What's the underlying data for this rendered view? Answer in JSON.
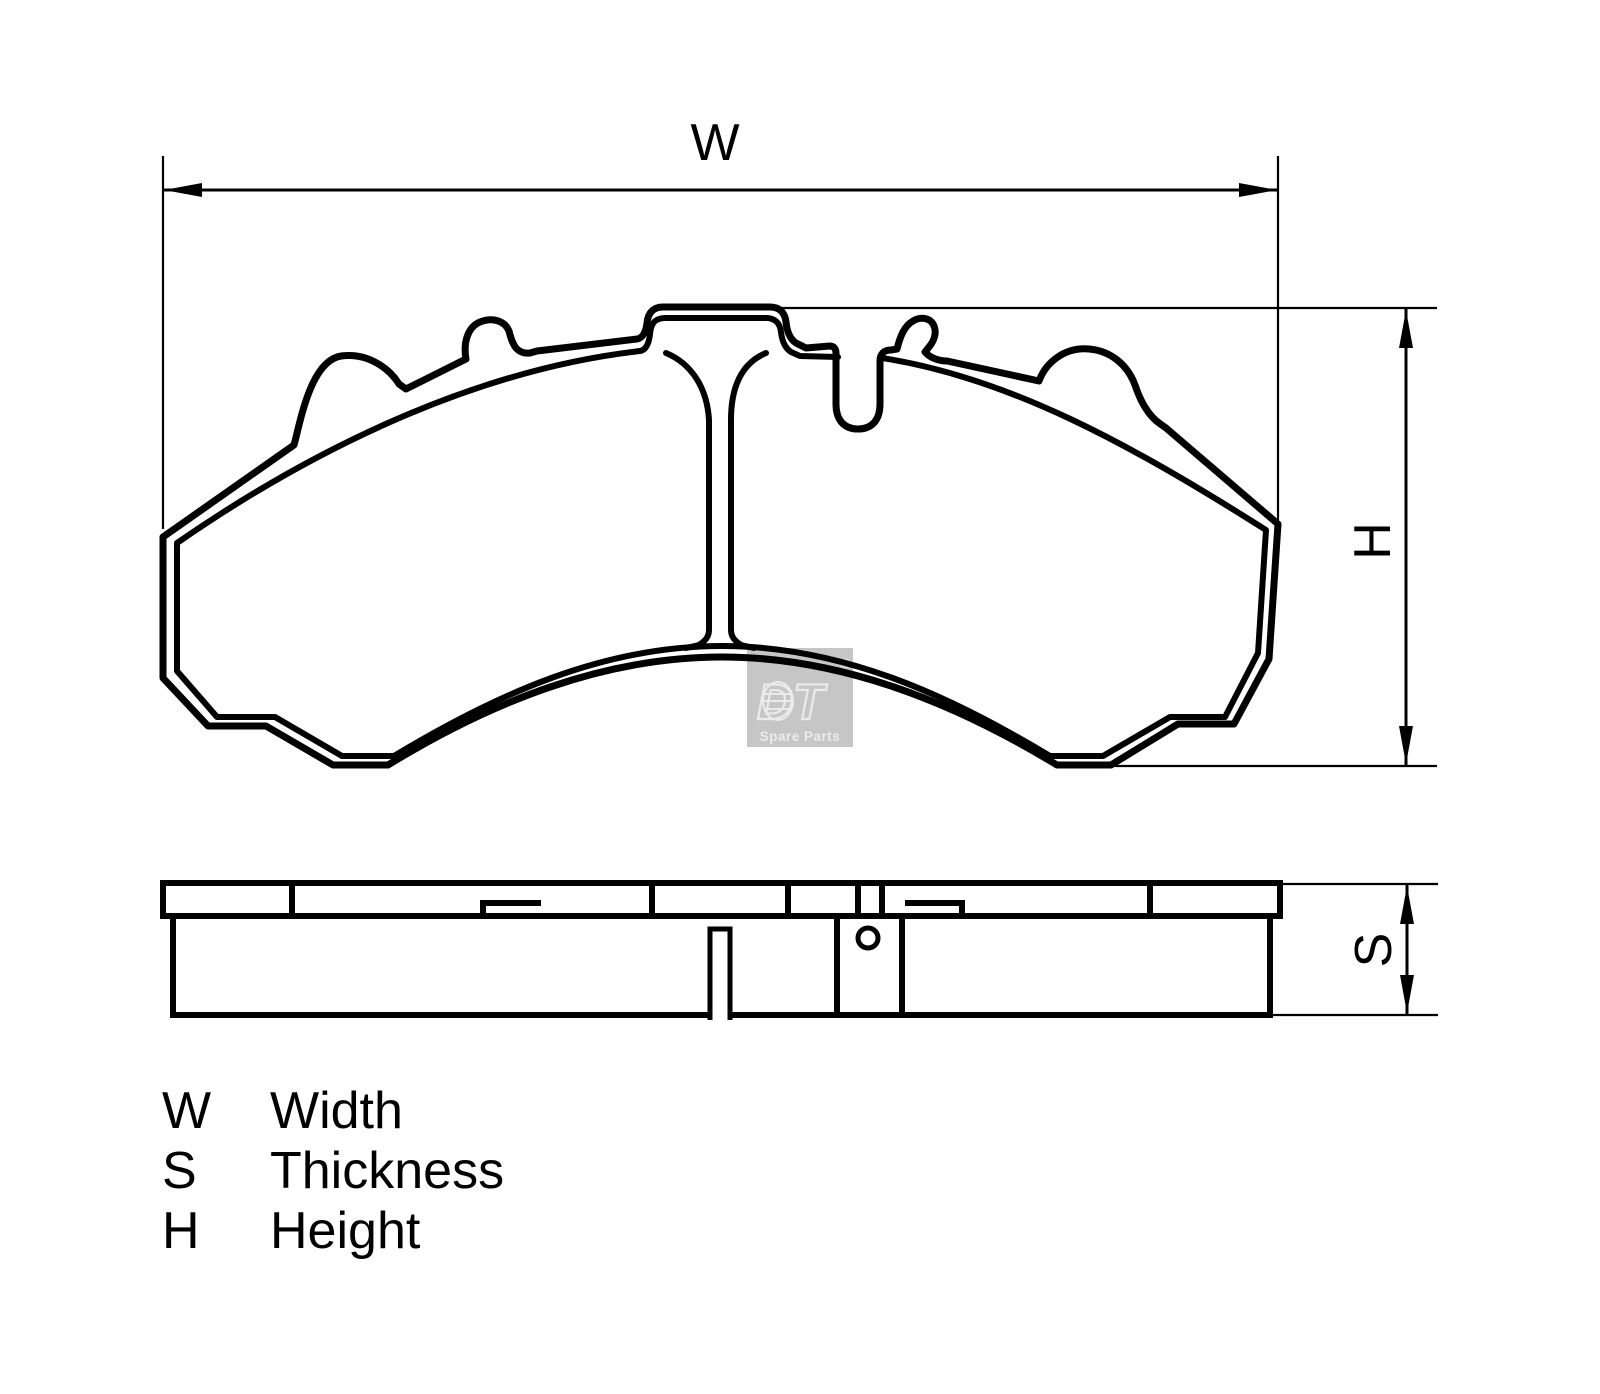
{
  "drawing": {
    "dims": {
      "width_symbol": "W",
      "height_symbol": "H",
      "thickness_symbol": "S"
    },
    "legend": {
      "rows": [
        {
          "symbol": "W",
          "label": "Width"
        },
        {
          "symbol": "S",
          "label": "Thickness"
        },
        {
          "symbol": "H",
          "label": "Height"
        }
      ]
    },
    "watermark": {
      "brand": "DT",
      "registered": "®",
      "subtitle": "Spare Parts"
    },
    "colors": {
      "line": "#000000",
      "background": "#ffffff",
      "watermark_box": "#c6c6c6",
      "watermark_glyph": "#ebebeb"
    }
  }
}
